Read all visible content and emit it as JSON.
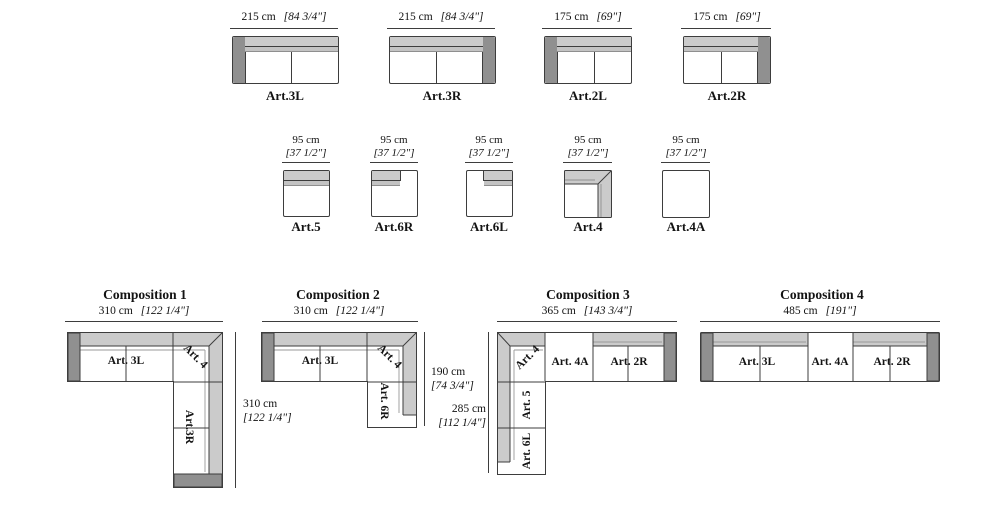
{
  "row1": {
    "items": [
      {
        "label": "Art.3L",
        "dim_cm": "215 cm",
        "dim_in": "[84 3/4\"]"
      },
      {
        "label": "Art.3R",
        "dim_cm": "215 cm",
        "dim_in": "[84 3/4\"]"
      },
      {
        "label": "Art.2L",
        "dim_cm": "175 cm",
        "dim_in": "[69\"]"
      },
      {
        "label": "Art.2R",
        "dim_cm": "175 cm",
        "dim_in": "[69\"]"
      }
    ]
  },
  "row2": {
    "items": [
      {
        "label": "Art.5",
        "dim_cm": "95 cm",
        "dim_in": "[37 1/2\"]"
      },
      {
        "label": "Art.6R",
        "dim_cm": "95 cm",
        "dim_in": "[37 1/2\"]"
      },
      {
        "label": "Art.6L",
        "dim_cm": "95 cm",
        "dim_in": "[37 1/2\"]"
      },
      {
        "label": "Art.4",
        "dim_cm": "95 cm",
        "dim_in": "[37 1/2\"]"
      },
      {
        "label": "Art.4A",
        "dim_cm": "95 cm",
        "dim_in": "[37 1/2\"]"
      }
    ]
  },
  "compositions": [
    {
      "title": "Composition 1",
      "dim_w_cm": "310 cm",
      "dim_w_in": "[122 1/4\"]",
      "dim_h_cm": "310 cm",
      "dim_h_in": "[122 1/4\"]",
      "module_a": "Art. 3L",
      "module_b": "Art. 4",
      "module_c": "Art.3R"
    },
    {
      "title": "Composition 2",
      "dim_w_cm": "310 cm",
      "dim_w_in": "[122 1/4\"]",
      "dim_h_cm": "190 cm",
      "dim_h_in": "[74 3/4\"]",
      "module_a": "Art. 3L",
      "module_b": "Art. 4",
      "module_c": "Art. 6R"
    },
    {
      "title": "Composition 3",
      "dim_w_cm": "365 cm",
      "dim_w_in": "[143 3/4\"]",
      "dim_h_cm": "285 cm",
      "dim_h_in": "[112 1/4\"]",
      "module_a": "Art. 4",
      "module_b": "Art. 4A",
      "module_c": "Art. 2R",
      "module_d": "Art. 5",
      "module_e": "Art. 6L"
    },
    {
      "title": "Composition 4",
      "dim_w_cm": "485 cm",
      "dim_w_in": "[191\"]",
      "module_a": "Art. 3L",
      "module_b": "Art. 4A",
      "module_c": "Art. 2R"
    }
  ],
  "colors": {
    "armrest": "#909090",
    "backrest": "#cbcbcb",
    "outline": "#3d3d3d"
  }
}
